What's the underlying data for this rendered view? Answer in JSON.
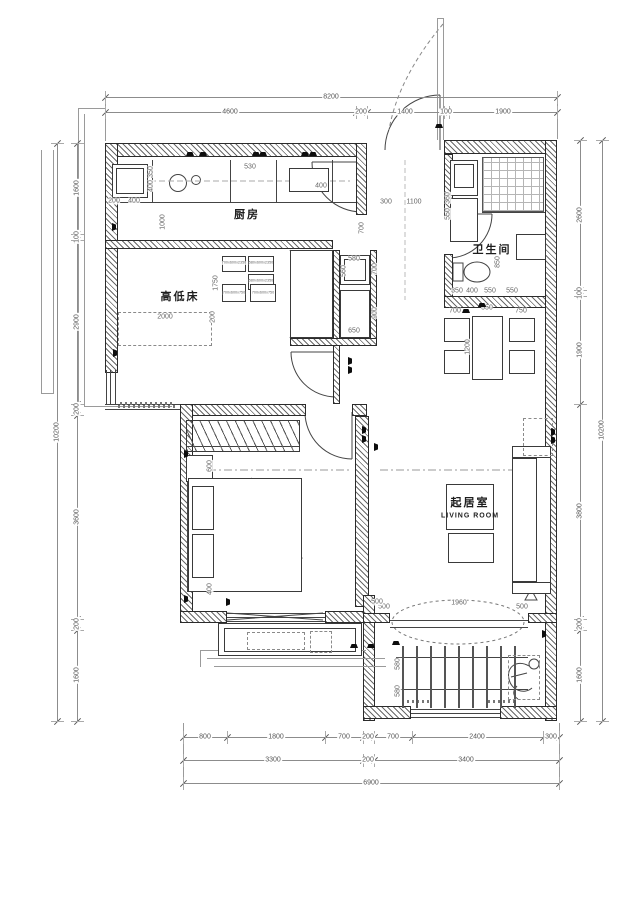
{
  "rooms": {
    "kitchen": "厨房",
    "bunk_bed": "高低床",
    "bathroom": "卫生间",
    "living_cn": "起居室",
    "living_en": "LIVING ROOM"
  },
  "dims": {
    "top_total": "8200",
    "top": [
      "4600",
      "200",
      "1400",
      "100",
      "1900"
    ],
    "left_total": "10200",
    "left": [
      "1600",
      "100",
      "2900",
      "200",
      "3600",
      "200",
      "1600"
    ],
    "right_total": "10200",
    "right": [
      "2600",
      "100",
      "1900",
      "3800",
      "200",
      "1600"
    ],
    "bottom_row1": [
      "800",
      "1800",
      "700",
      "200",
      "700",
      "2400",
      "300"
    ],
    "bottom_row2": [
      "3300",
      "200",
      "3400"
    ],
    "bottom_total": "6900"
  },
  "inner": {
    "kitchen": [
      "350",
      "400",
      "200",
      "400",
      "1000",
      "530",
      "400"
    ],
    "hall": [
      "300",
      "1100",
      "360",
      "550",
      "700"
    ],
    "bath": [
      "850",
      "350",
      "400",
      "550",
      "550"
    ],
    "bunk": [
      "1750",
      "2000",
      "200"
    ],
    "cabinet_sizes": [
      "700x600x2350",
      "580x600x2350",
      "580x600x2350",
      "700x600x750",
      "700x600x750"
    ],
    "storage": [
      "580",
      "560",
      "700",
      "900",
      "650"
    ],
    "living": [
      "700",
      "550",
      "750",
      "1200"
    ],
    "balcony": [
      "500",
      "1960",
      "500",
      "580",
      "580"
    ],
    "bedroom": [
      "600",
      "400",
      "500"
    ]
  }
}
